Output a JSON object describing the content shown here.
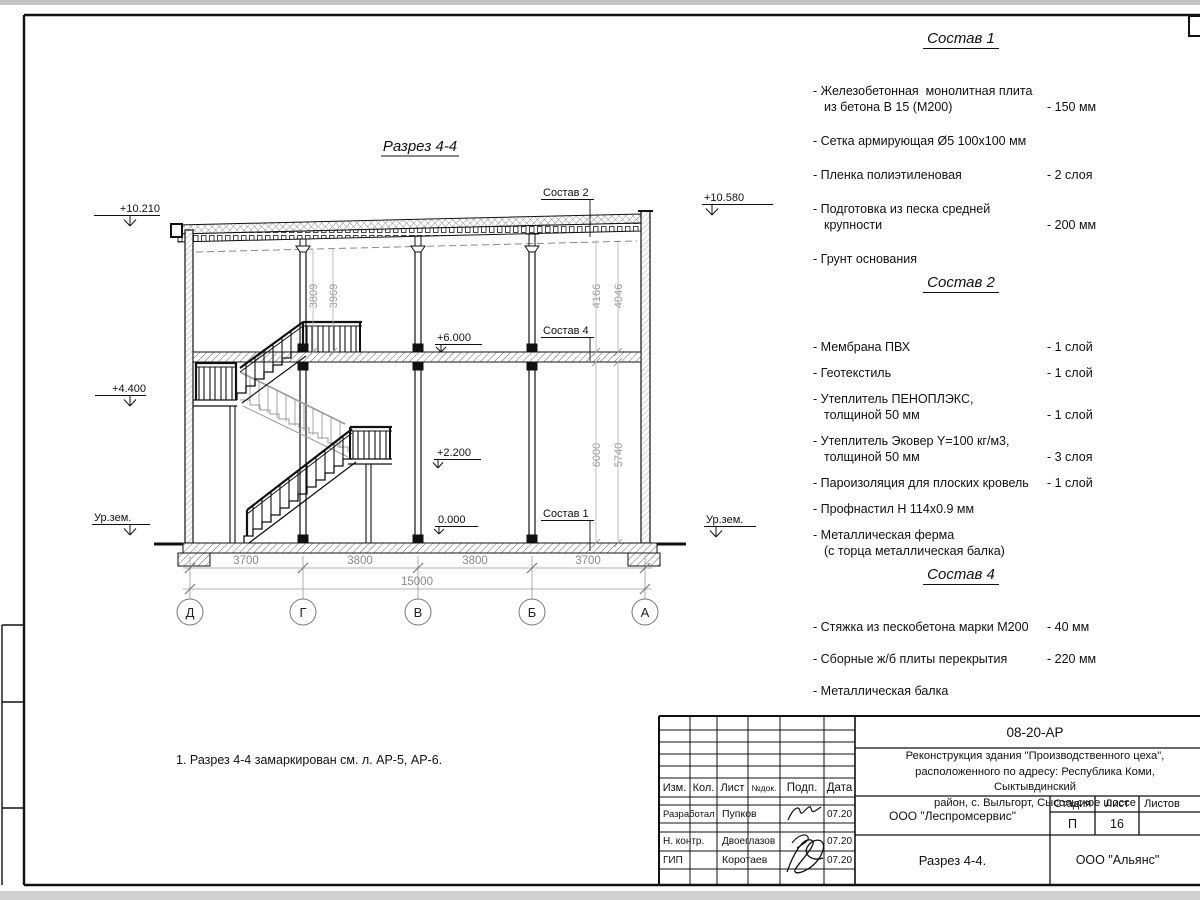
{
  "drawing": {
    "title": "Разрез 4-4",
    "note": "1. Разрез 4-4 замаркирован см. л. АР-5, АР-6.",
    "elevations": {
      "roof_left": "+10.210",
      "roof_right": "+10.580",
      "floor2": "+6.000",
      "landing_upper": "+4.400",
      "landing_lower": "+2.200",
      "ground_floor": "0.000",
      "ground_level_left": "Ур.зем.",
      "ground_level_right": "Ур.зем."
    },
    "layer_labels": {
      "sostav1": "Состав 1",
      "sostav2": "Состав 2",
      "sostav4": "Состав 4"
    },
    "dims": {
      "left_pair": [
        "3809",
        "3969"
      ],
      "right_upper_pair": [
        "4166",
        "4046"
      ],
      "right_lower_pair": [
        "6000",
        "5740"
      ],
      "spans": [
        "3700",
        "3800",
        "3800",
        "3700"
      ],
      "total": "15000"
    },
    "axes": [
      "Д",
      "Г",
      "В",
      "Б",
      "А"
    ]
  },
  "compositions": [
    {
      "title": "Состав 1",
      "items": [
        {
          "name": "- Железобетонная  монолитная плита\nиз бетона В 15 (М200)",
          "value": "- 150 мм"
        },
        {
          "name": "- Сетка армирующая Ø5 100x100 мм",
          "value": ""
        },
        {
          "name": "- Пленка полиэтиленовая",
          "value": "-  2 слоя"
        },
        {
          "name": "- Подготовка из песка средней\nкрупности",
          "value": "- 200 мм"
        },
        {
          "name": "- Грунт основания",
          "value": ""
        }
      ]
    },
    {
      "title": "Состав 2",
      "items": [
        {
          "name": "- Мембрана ПВХ",
          "value": "- 1 слой"
        },
        {
          "name": "- Геотекстиль",
          "value": "- 1 слой"
        },
        {
          "name": "- Утеплитель ПЕНОПЛЭКС,\nтолщиной 50 мм",
          "value": "- 1 слой"
        },
        {
          "name": "- Утеплитель Эковер Y=100 кг/м3,\nтолщиной 50 мм",
          "value": "- 3 слоя"
        },
        {
          "name": "- Пароизоляция для плоских кровель",
          "value": "- 1 слой"
        },
        {
          "name": "- Профнастил Н 114x0.9 мм",
          "value": ""
        },
        {
          "name": "- Металлическая ферма\n(с торца металлическая балка)",
          "value": ""
        }
      ]
    },
    {
      "title": "Состав 4",
      "items": [
        {
          "name": "- Стяжка из пескобетона марки М200",
          "value": "- 40 мм"
        },
        {
          "name": "- Сборные ж/б плиты перекрытия",
          "value": "- 220 мм"
        },
        {
          "name": "- Металлическая балка",
          "value": ""
        }
      ]
    }
  ],
  "title_block": {
    "doc_code": "08-20-АР",
    "project_lines": [
      "Реконструкция здания \"Производственного цеха\",",
      "расположенного по адресу: Республика Коми, Сыктывдинский",
      "район, с. Выльгорт, Сысольское шоссе"
    ],
    "columns": [
      "Изм.",
      "Кол.",
      "Лист",
      "№док.",
      "Подп.",
      "Дата"
    ],
    "rows": [
      {
        "role": "Разработал",
        "name": "Пупков",
        "date": "07.20"
      },
      {
        "role": "Н. контр.",
        "name": "Двоеглазов",
        "date": "07.20"
      },
      {
        "role": "ГИП",
        "name": "Коротаев",
        "date": "07.20"
      }
    ],
    "org": "ООО \"Леспромсервис\"",
    "stage_label": "Стадия",
    "sheet_label": "Лист",
    "sheets_label": "Листов",
    "stage": "П",
    "sheet_no": "16",
    "sheet_title": "Разрез 4-4.",
    "customer": "ООО \"Альянс\""
  }
}
